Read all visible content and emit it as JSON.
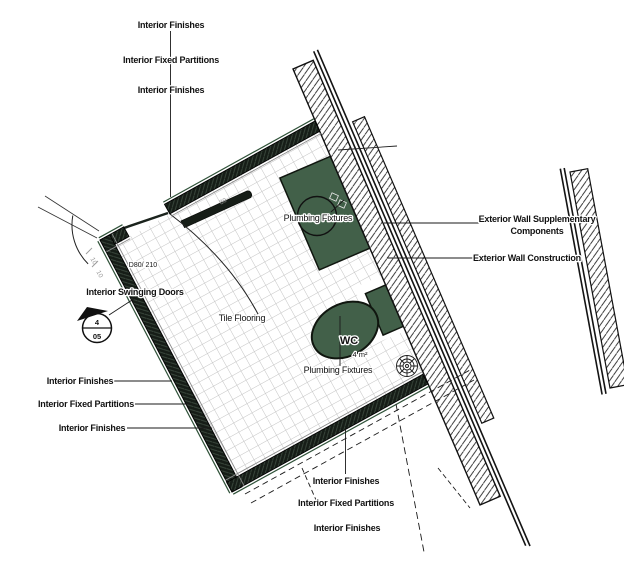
{
  "labels": {
    "top_1": "Interior Finishes",
    "top_2": "Interior Fixed Partitions",
    "top_3": "Interior Finishes",
    "left_1": "Interior Finishes",
    "left_2": "Interior Fixed Partitions",
    "left_3": "Interior Finishes",
    "bottom_1": "Interior Finishes",
    "bottom_2": "Interior Fixed Partitions",
    "bottom_3": "Interior Finishes",
    "ext_supp_1": "Exterior Wall Supplementary",
    "ext_supp_2": "Components",
    "ext_constr": "Exterior Wall Construction",
    "plumbing_upper": "Plumbing Fixtures",
    "plumbing_lower": "Plumbing Fixtures",
    "tile_flooring": "Tile Flooring",
    "swinging_doors": "Interior Swinging Doors",
    "door_size": "D80/ 210",
    "room_name": "WC",
    "room_area": "4 m²",
    "section_detail": "4",
    "section_sheet": "05",
    "dim_1": "10",
    "dim_2": "10",
    "dim_3": "80"
  },
  "colors": {
    "fixture_green": "#426049",
    "wall_dark": "#161d17",
    "accent_green": "#2f5138",
    "tile_line": "#c3c3c3",
    "line": "#1a1a1a",
    "dim_gray": "#9a9a9a"
  }
}
